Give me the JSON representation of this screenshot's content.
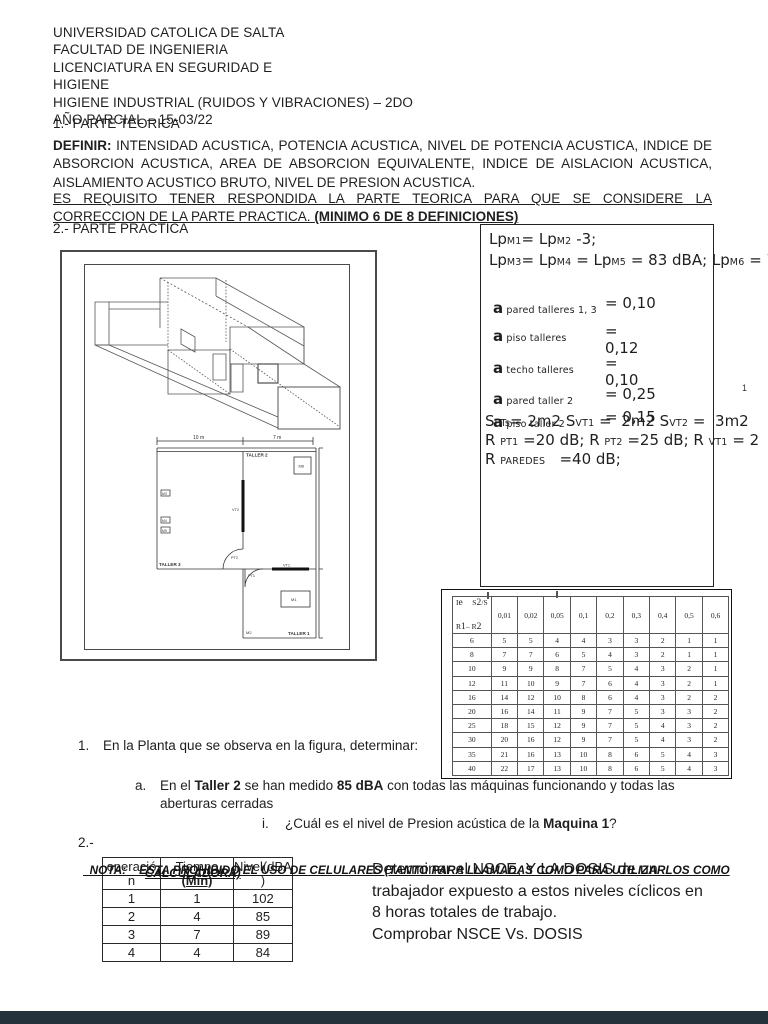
{
  "header": {
    "lines": [
      "UNIVERSIDAD CATOLICA DE SALTA",
      "FACULTAD  DE INGENIERIA",
      "LICENCIATURA EN SEGURIDAD E",
      "HIGIENE",
      "HIGIENE INDUSTRIAL (RUIDOS Y VIBRACIONES) – 2DO",
      "AÑO PARCIAL – 15-03/22"
    ]
  },
  "theory": {
    "title": "1.- PARTE TEORICA",
    "definir_label": "DEFINIR:",
    "definir_body": " INTENSIDAD ACUSTICA, POTENCIA ACUSTICA, NIVEL DE POTENCIA ACUSTICA, INDICE DE ABSORCION ACUSTICA, AREA DE ABSORCION EQUIVALENTE, INDICE DE AISLACION ACUSTICA, AISLAMIENTO ACUSTICO BRUTO, NIVEL DE PRESION ACUSTICA.",
    "requisito_body": "ES REQUISITO TENER RESPONDIDA LA PARTE TEORICA PARA QUE SE CONSIDERE LA CORRECCION DE LA PARTE PRACTICA. ",
    "requisito_bold": "(MINIMO 6 DE 8 DEFINICIONES)"
  },
  "practice": {
    "title": "2.- PARTE PRACTICA"
  },
  "formula_box": {
    "lp_line1": [
      {
        "t": "Lp"
      },
      {
        "s": "M1"
      },
      {
        "t": "= Lp"
      },
      {
        "s": "M2"
      },
      {
        "t": " -3;"
      }
    ],
    "lp_line2": [
      {
        "t": "Lp"
      },
      {
        "s": "M3"
      },
      {
        "t": "= Lp"
      },
      {
        "s": "M4"
      },
      {
        "t": " = Lp"
      },
      {
        "s": "M5"
      },
      {
        "t": " = 83 dBA; Lp"
      },
      {
        "s": "M6"
      },
      {
        "t": " = 7"
      }
    ],
    "alphas": [
      {
        "label": [
          {
            "t": "a"
          },
          {
            "s": "  pared talleres 1, 3"
          }
        ],
        "value": "= 0,10"
      },
      {
        "label": [
          {
            "t": "a"
          },
          {
            "s": "  piso  talleres"
          }
        ],
        "value": "=\n0,12"
      },
      {
        "label": [
          {
            "t": "a"
          },
          {
            "s": "  techo talleres"
          }
        ],
        "value": "=\n 0,10"
      },
      {
        "label": [
          {
            "t": "a"
          },
          {
            "s": "  pared taller 2"
          }
        ],
        "value": "= 0,25"
      },
      {
        "label": [
          {
            "t": "a"
          },
          {
            "s": "  piso taller 2"
          }
        ],
        "value": "= 0,15"
      }
    ],
    "s_line": [
      {
        "t": "S"
      },
      {
        "s": "PTs"
      },
      {
        "t": "= 2m2 S"
      },
      {
        "s": "VT1"
      },
      {
        "t": " =  2m2 S"
      },
      {
        "s": "VT2"
      },
      {
        "t": " =  3m2"
      }
    ],
    "r_line1": [
      {
        "t": "R "
      },
      {
        "s": "PT1"
      },
      {
        "t": " =20 dB; R "
      },
      {
        "s": "PT2"
      },
      {
        "t": " =25 dB; R "
      },
      {
        "s": "VT1"
      },
      {
        "t": " = 2"
      }
    ],
    "r_line2": [
      {
        "t": "R "
      },
      {
        "s": "PAREDES"
      },
      {
        "t": "   =40 dB;"
      }
    ],
    "stray_mark": "1"
  },
  "figure": {
    "dim_left": "10 m",
    "dim_right": "7 m",
    "rooms": {
      "taller1": "TALLER 1",
      "taller2": "TALLER 2",
      "taller3": "TALLER 3"
    },
    "machines": {
      "m1": "M1",
      "m2": "M2",
      "m3": "M3",
      "m4": "M4",
      "m5": "M5",
      "m6": "M6"
    },
    "openings": {
      "pt1": "PT1",
      "pt2": "PT2",
      "vt1": "VT1",
      "vt2": "VT2"
    }
  },
  "ie_table": {
    "corner_top": [
      {
        "t": "I"
      },
      {
        "s": "e"
      },
      {
        "t": "     S"
      },
      {
        "s": "2"
      },
      {
        "t": "/S"
      }
    ],
    "corner_bottom": [
      {
        "t": "R"
      },
      {
        "s": "1"
      },
      {
        "t": "– R"
      },
      {
        "s": "2"
      }
    ],
    "col_headers": [
      "0,01",
      "0,02",
      "0,05",
      "0,1",
      "0,2",
      "0,3",
      "0,4",
      "0,5",
      "0,6"
    ],
    "rows": [
      [
        "6",
        "5",
        "5",
        "4",
        "4",
        "3",
        "3",
        "2",
        "1",
        "1"
      ],
      [
        "8",
        "7",
        "7",
        "6",
        "5",
        "4",
        "3",
        "2",
        "1",
        "1"
      ],
      [
        "10",
        "9",
        "9",
        "8",
        "7",
        "5",
        "4",
        "3",
        "2",
        "1"
      ],
      [
        "12",
        "11",
        "10",
        "9",
        "7",
        "6",
        "4",
        "3",
        "2",
        "1"
      ],
      [
        "16",
        "14",
        "12",
        "10",
        "8",
        "6",
        "4",
        "3",
        "2",
        "2"
      ],
      [
        "20",
        "16",
        "14",
        "11",
        "9",
        "7",
        "5",
        "3",
        "3",
        "2"
      ],
      [
        "25",
        "18",
        "15",
        "12",
        "9",
        "7",
        "5",
        "4",
        "3",
        "2"
      ],
      [
        "30",
        "20",
        "16",
        "12",
        "9",
        "7",
        "5",
        "4",
        "3",
        "2"
      ],
      [
        "35",
        "21",
        "16",
        "13",
        "10",
        "8",
        "6",
        "5",
        "4",
        "3"
      ],
      [
        "40",
        "22",
        "17",
        "13",
        "10",
        "8",
        "6",
        "5",
        "4",
        "3"
      ]
    ]
  },
  "questions": {
    "q1_marker": "1.",
    "q1_text": "En la Planta que se observa en la figura, determinar:",
    "qa_marker": "a.",
    "qa_runs": [
      {
        "t": "En el "
      },
      {
        "b": "Taller 2"
      },
      {
        "t": " se han medido "
      },
      {
        "b": "85 dBA"
      },
      {
        "t": " con todas las máquinas funcionando y todas las aberturas cerradas"
      }
    ],
    "qi_marker": "i.",
    "qi_runs": [
      {
        "t": "¿Cuál es el nivel de Presion acústica de la "
      },
      {
        "b": "Maquina 1"
      },
      {
        "t": "?"
      }
    ],
    "q2_marker": "2.-"
  },
  "nota": {
    "line1_label": "NOTA:",
    "line1_text": "    ESTA PROHIBIDO EL USO DE CELULARES (TANTO PARA LLAMADAS COMO PARA UTILIZARLOS COMO",
    "line2_text": "CALCULADORA)"
  },
  "dosis_table": {
    "h1a": "operació",
    "h1b": "n",
    "h2a": "Tiempo",
    "h2b": "(Min)",
    "h3a": "Nivel(dBA",
    "h3b": ")",
    "rows": [
      [
        "1",
        "1",
        "102"
      ],
      [
        "2",
        "4",
        "85"
      ],
      [
        "3",
        "7",
        "89"
      ],
      [
        "4",
        "4",
        "84"
      ]
    ]
  },
  "task_note": {
    "lines": [
      "Determinar el NSCE, Y LA DOSIS de un",
      "trabajador expuesto a estos niveles cíclicos en",
      "8 horas totales de trabajo.",
      "Comprobar NSCE Vs. DOSIS"
    ]
  },
  "colors": {
    "page_bg": "#ffffff",
    "text": "#1f1f1f",
    "bottom_bar": "#24333b"
  }
}
